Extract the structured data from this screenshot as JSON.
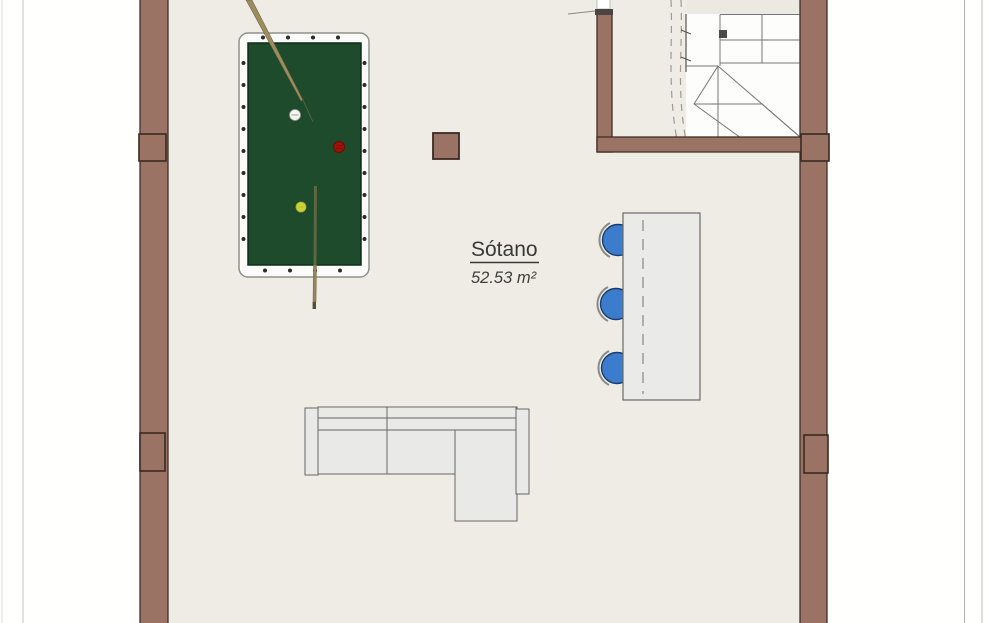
{
  "plan": {
    "room": {
      "label": "Sótano",
      "area": "52.53 m²"
    },
    "objects": {
      "pool_table": {
        "balls": [
          "white",
          "red",
          "yellow"
        ],
        "cue_count": 2
      },
      "bar": {
        "stool_count": 3
      },
      "sofa": {
        "type": "sectional"
      },
      "staircase": {
        "type": "winder"
      }
    }
  },
  "colors": {
    "background": "#fffffd",
    "floor": "#efece5",
    "wall": "#9b7365",
    "wall_outline": "#422f26",
    "stair_white": "#fdfdfb",
    "table_frame": "#fbfbf9",
    "felt": "#1d4b2b",
    "felt_edge": "#0e2d1a",
    "cue_stick": "#9c8c5e",
    "ball_white": "#f5f5f3",
    "ball_red": "#9c1408",
    "ball_yellow": "#ccd135",
    "stool": "#3b7ccc",
    "stool_outline": "#1b3c6e",
    "counter": "#eaeae8",
    "sofa": "#e9e9e7",
    "text": "#383838"
  }
}
